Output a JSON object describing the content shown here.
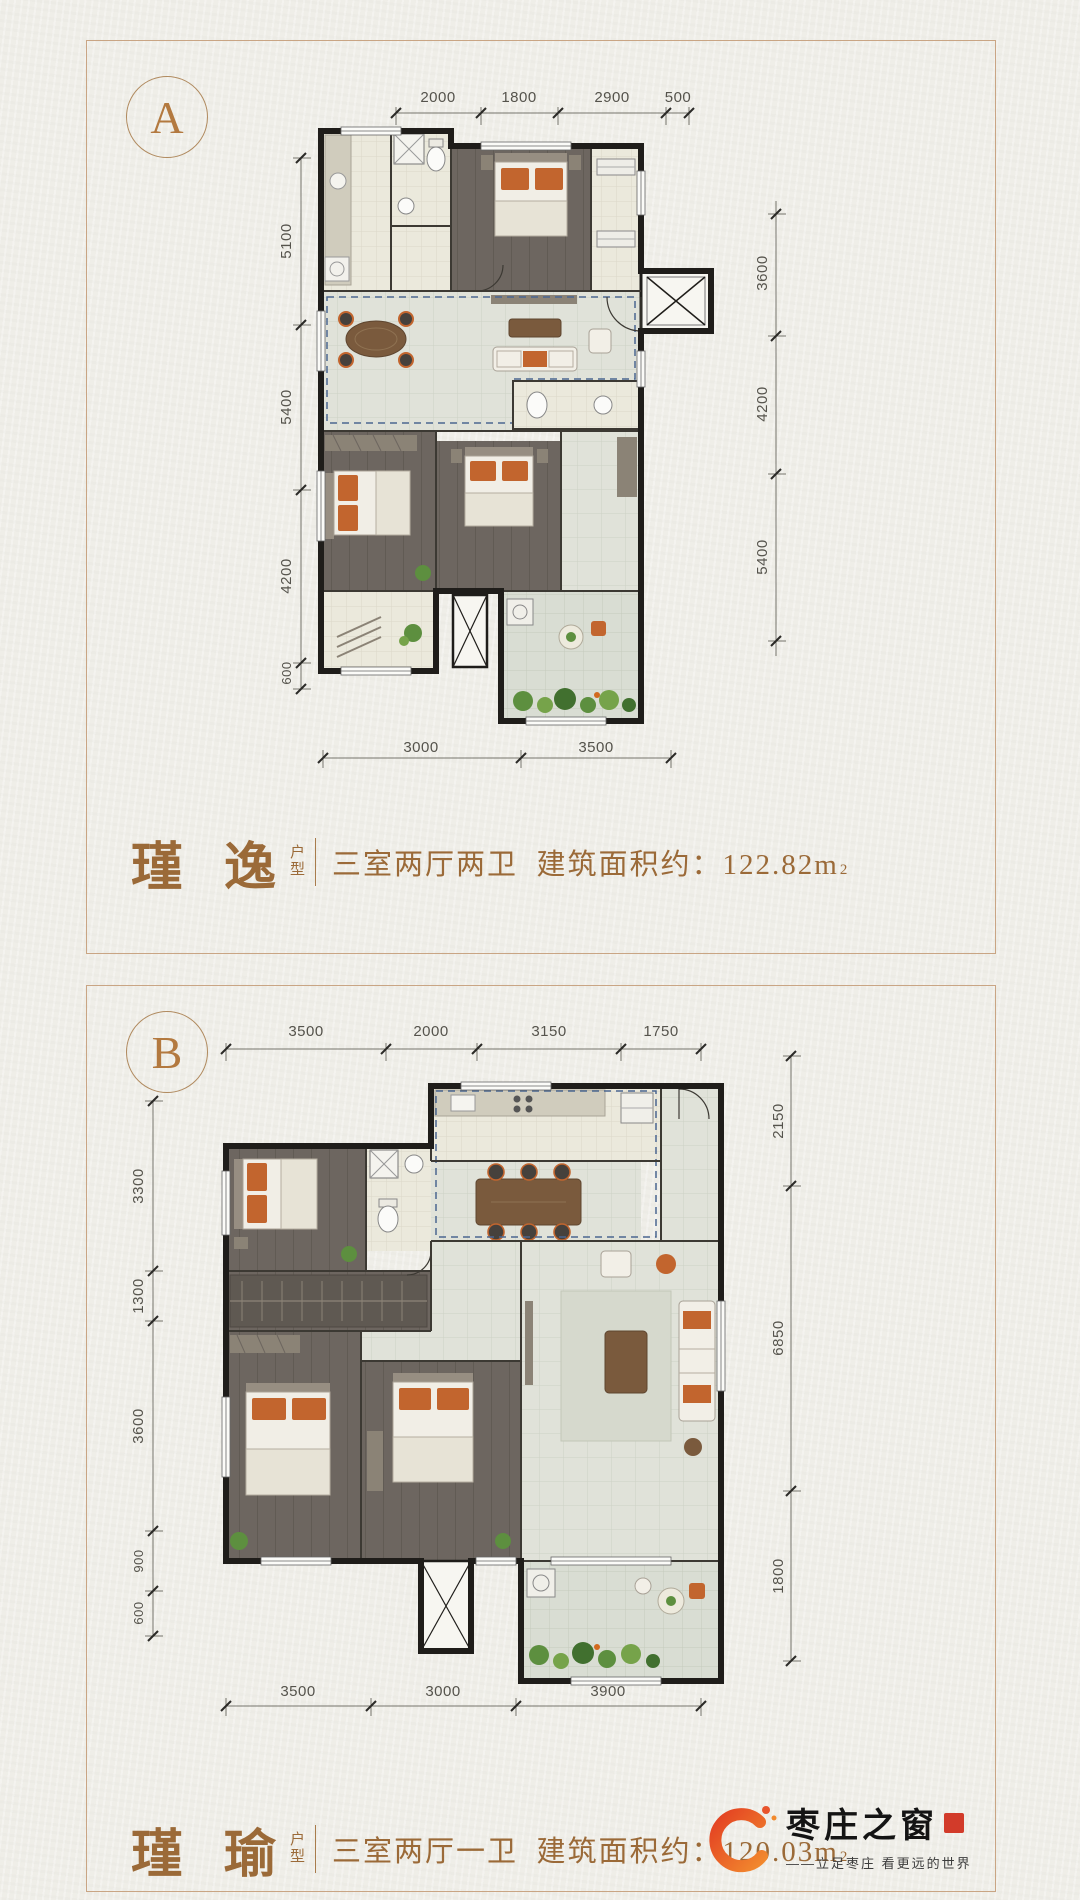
{
  "theme": {
    "background": "#efeee8",
    "card_border": "#c9a584",
    "accent": "#9b6a38",
    "dim_text": "#55534c",
    "wall": "#1f1d1a",
    "dash_blue": "#4a6690",
    "orange": "#c2652e"
  },
  "card_a": {
    "badge": "A",
    "dims": {
      "top": [
        "2000",
        "1800",
        "2900",
        "500"
      ],
      "left": [
        "5100",
        "5400",
        "4200",
        "600"
      ],
      "right": [
        "3600",
        "4200",
        "5400"
      ],
      "bottom": [
        "3000",
        "3500"
      ]
    },
    "title": {
      "name": "瑾 逸",
      "type_top": "户",
      "type_bottom": "型",
      "desc": "三室两厅两卫  建筑面积约：",
      "area": "122.82m",
      "area_exp": "2"
    }
  },
  "card_b": {
    "badge": "B",
    "dims": {
      "top": [
        "3500",
        "2000",
        "3150",
        "1750"
      ],
      "left": [
        "3300",
        "1300",
        "3600",
        "900",
        "600"
      ],
      "right": [
        "2150",
        "6850",
        "1800"
      ],
      "bottom": [
        "3500",
        "3000",
        "3900"
      ]
    },
    "title": {
      "name": "瑾 瑜",
      "type_top": "户",
      "type_bottom": "型",
      "desc": "三室两厅一卫  建筑面积约：",
      "area": "120.03m",
      "area_exp": "2"
    }
  },
  "logo": {
    "name": "枣庄之窗",
    "tagline": "——立足枣庄 看更远的世界"
  }
}
